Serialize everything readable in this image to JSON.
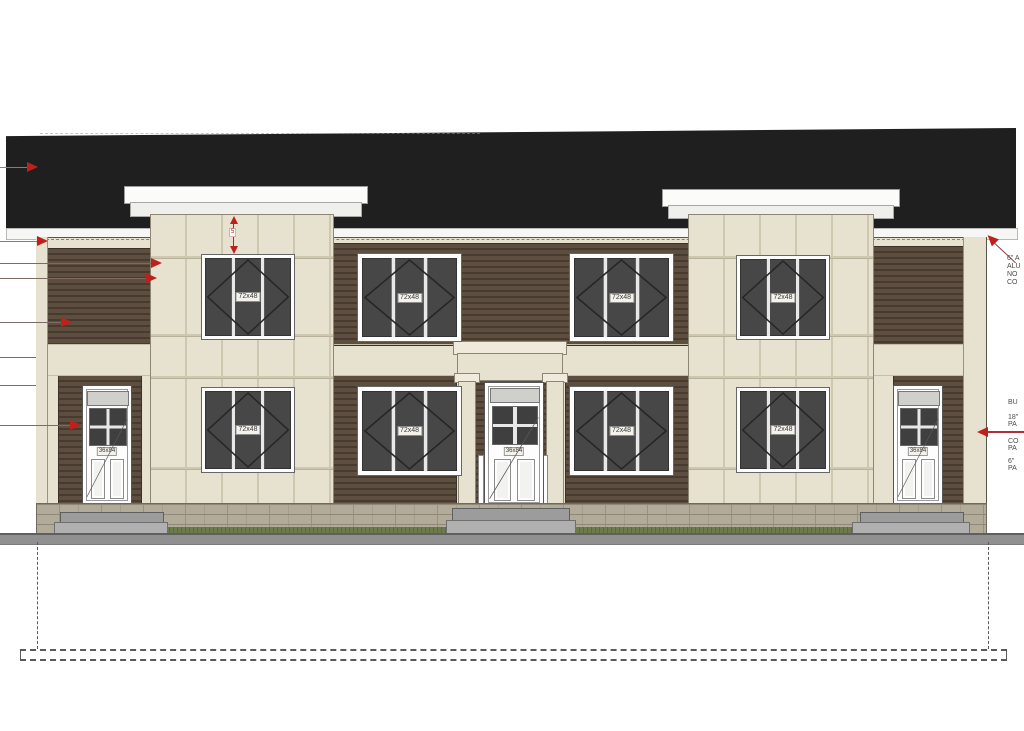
{
  "drawing": {
    "type": "architectural-front-elevation",
    "windows": {
      "size_label": "72x48"
    },
    "doors": {
      "size_label": "36x84"
    },
    "dimension_marker": {
      "value": "5"
    },
    "annotations": {
      "roof_note": {
        "lines": [
          "6\" A",
          "ALU",
          "NO",
          "CO"
        ]
      },
      "wall_note": {
        "lines": [
          "BU",
          "18\"",
          "PA",
          "CO",
          "PA",
          "6\"",
          "PA"
        ]
      }
    },
    "colors": {
      "roof": "#1f1f1f",
      "siding_brown": "#5d4e40",
      "trim_cream": "#e7e2cf",
      "glass": "#474747",
      "stone_base": "#b3ab99",
      "grass": "#6d7a4c",
      "ground": "#909090",
      "annotation_red": "#c0201c"
    }
  }
}
